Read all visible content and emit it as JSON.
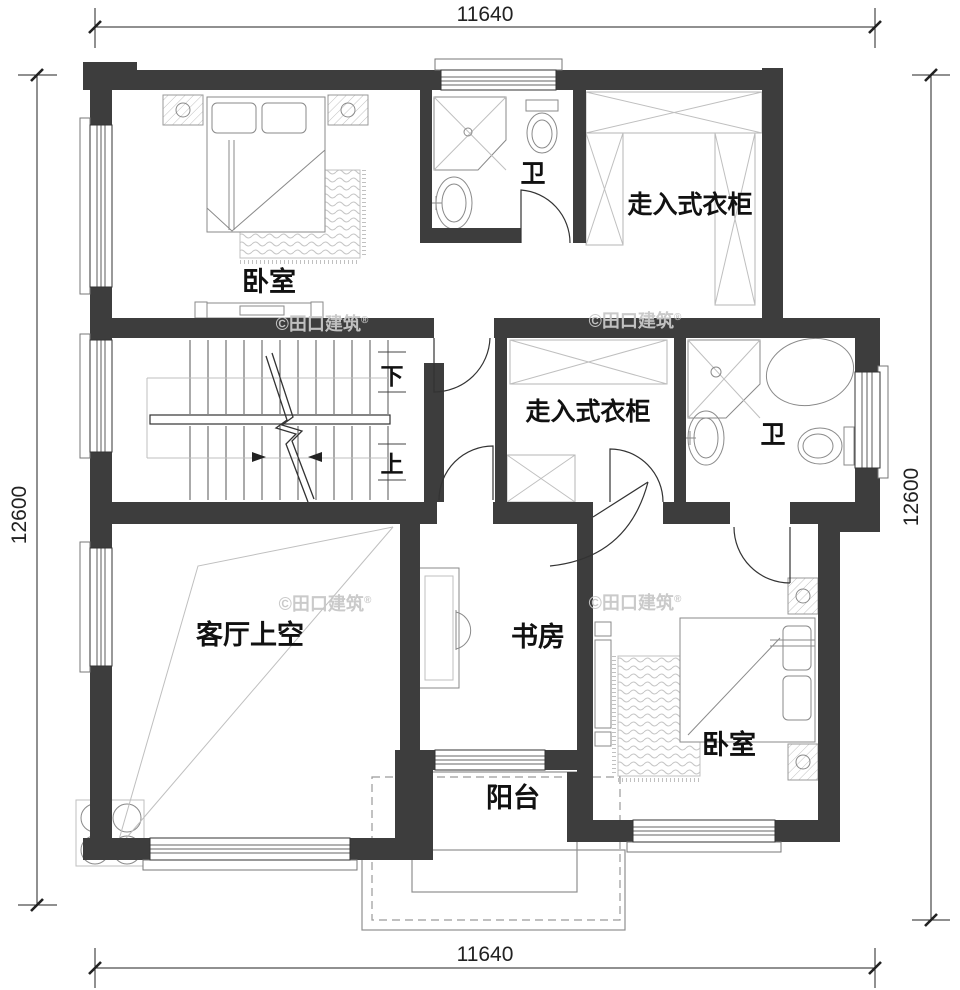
{
  "dimensions": {
    "top": "11640",
    "bottom": "11640",
    "left": "12600",
    "right": "12600"
  },
  "labels": {
    "bedroom_top": "卧室",
    "bath_top": "卫",
    "closet_top": "走入式衣柜",
    "closet_mid": "走入式衣柜",
    "bath_mid": "卫",
    "living": "客厅上空",
    "study": "书房",
    "bedroom_bottom": "卧室",
    "balcony": "阳台",
    "stair_down": "下",
    "stair_up": "上"
  },
  "watermark": {
    "text": "©田口建筑",
    "reg": "®"
  },
  "colors": {
    "paper": "#ffffff",
    "wall": "#3d3d3d",
    "line": "#222222",
    "fixture": "#8a8a8a",
    "hatch": "#bfbfbf",
    "watermark": "#c8c8c8"
  }
}
